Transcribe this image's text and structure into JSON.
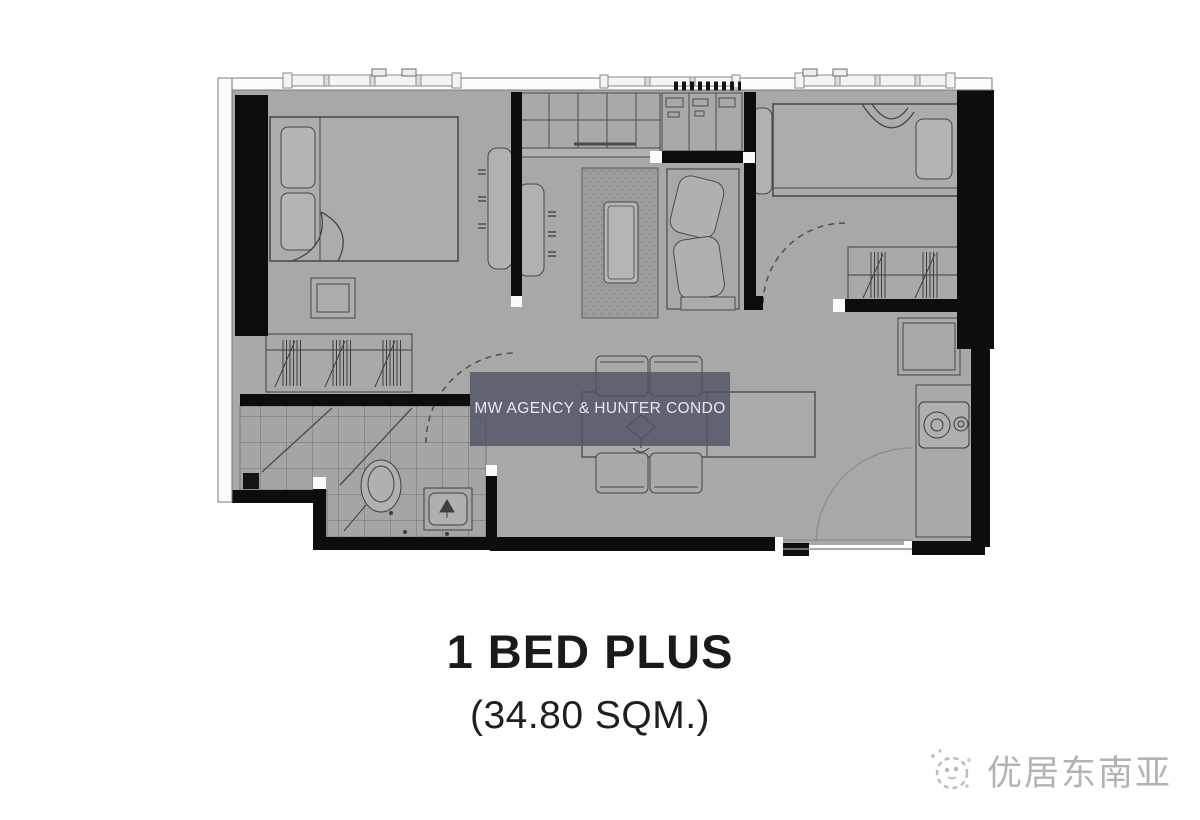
{
  "plan": {
    "title": "1 BED PLUS",
    "area_label": "(34.80 SQM.)"
  },
  "watermark": {
    "text": "MW AGENCY & HUNTER CONDO"
  },
  "brand": {
    "name": "优居东南亚"
  },
  "colors": {
    "background": "#ffffff",
    "floor": "#a8a8a6",
    "wall": "#0d0d0d",
    "furniture_fill": "#b1b1af",
    "furniture_outline": "#464644",
    "watermark_bg": "rgba(77,82,100,0.8)",
    "watermark_text": "#e6e9ef",
    "title_text": "#1a1a1a",
    "logo_text": "#b3b3b3"
  }
}
